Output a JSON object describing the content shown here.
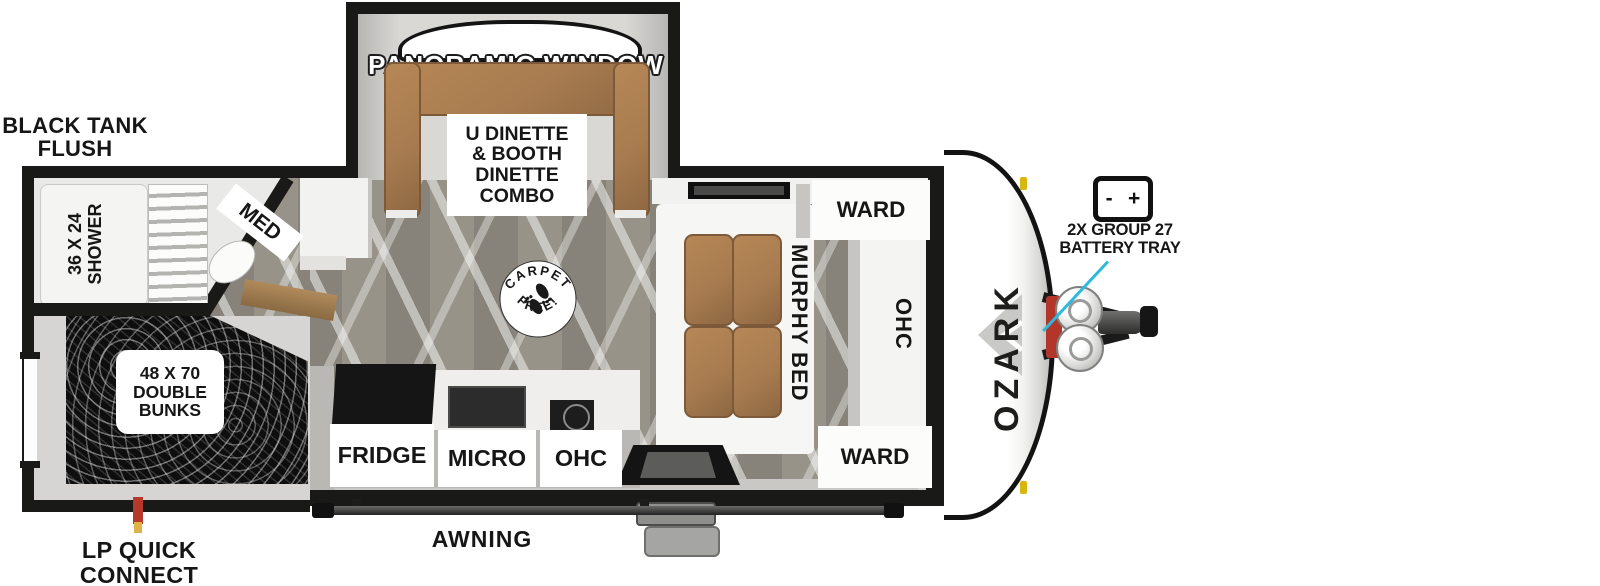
{
  "brand": {
    "name": "OZARK"
  },
  "callouts": {
    "black_tank_flush": "BLACK  TANK\nFLUSH",
    "lp_quick_connect": "LP QUICK\nCONNECT",
    "awning": "AWNING",
    "battery_tray": "2X GROUP 27\nBATTERY TRAY",
    "battery_minus": "-",
    "battery_plus": "+"
  },
  "slide_out": {
    "panoramic_window": "PANORAMIC WINDOW",
    "dinette": "U DINETTE\n& BOOTH\nDINETTE\nCOMBO"
  },
  "bathroom": {
    "shower": "36 X 24\nSHOWER",
    "med": "MED"
  },
  "bunk_room": {
    "double_bunks": "48 X 70\nDOUBLE\nBUNKS"
  },
  "kitchen": {
    "fridge": "FRIDGE",
    "micro": "MICRO",
    "ohc": "OHC"
  },
  "bedroom": {
    "ward_top": "WARD",
    "murphy_bed": "MURPHY BED",
    "ohc": "OHC",
    "ward_bottom": "WARD"
  },
  "badge": {
    "top": "CARPET",
    "bottom": "FREE!"
  },
  "colors": {
    "wall_black": "#191917",
    "interior_gray": "#d6d5d3",
    "floor_taupe": "#908c84",
    "cushion_brown": "#a87c50",
    "bunk_black": "#0e0e0e",
    "callout_cyan": "#2cb9dd",
    "lp_red": "#b7392b",
    "lp_yellow": "#ddb348",
    "marker_yellow": "#d8b60f"
  }
}
